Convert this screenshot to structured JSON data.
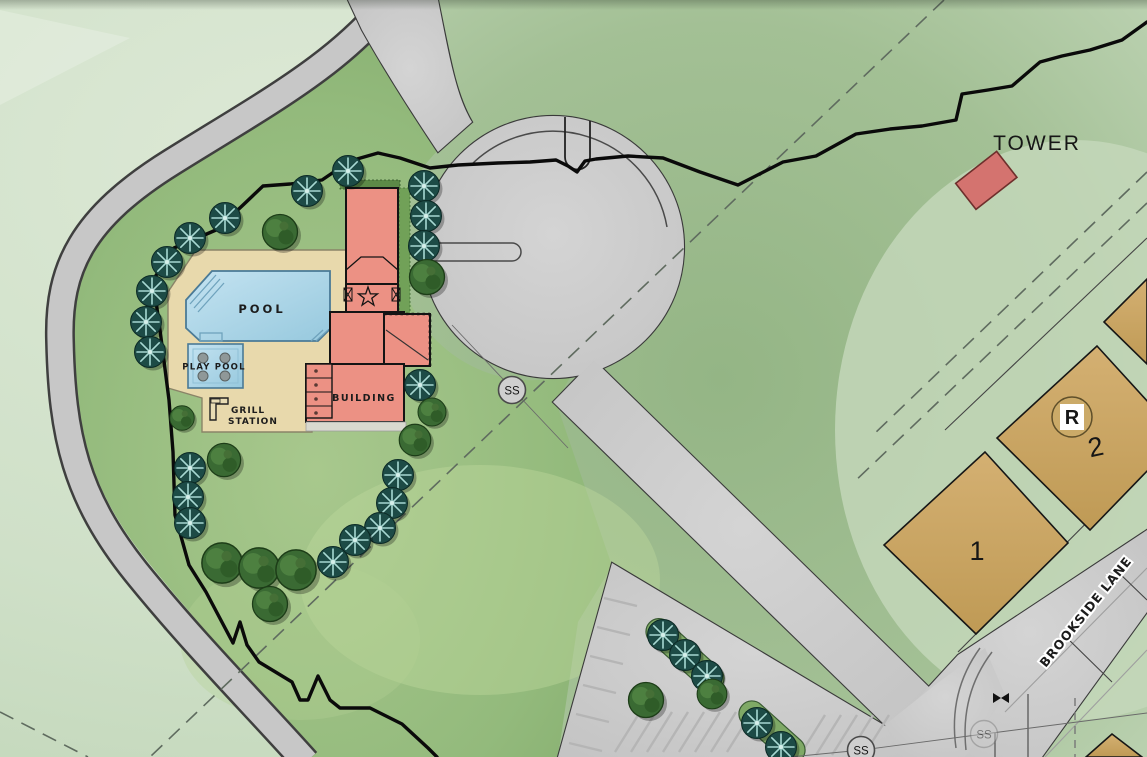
{
  "map": {
    "title": "Pool amenity site plan",
    "labels": {
      "tower": "TOWER",
      "pool": "POOL",
      "play_pool": "PLAY POOL",
      "grill_line1": "GRILL",
      "grill_line2": "STATION",
      "building": "BUILDING",
      "street": "BROOKSIDE LANE",
      "lot_r": "R",
      "lot_2": "2",
      "lot_1": "1",
      "ss": "SS"
    },
    "colors": {
      "background_green": "#cfe0c8",
      "field_green": "#9abb8c",
      "lawn_green": "#8fb878",
      "pavement_gray": "#c9c9c9",
      "deck_tan": "#e8d9ac",
      "water_blue": "#aed6e8",
      "building_salmon": "#ec9184",
      "tower_red": "#d4736f",
      "lot_tan": "#c9a463",
      "stream_black": "#0a0a0a",
      "tree_teal": "#1d4b46",
      "tree_green": "#3a6a33"
    }
  }
}
